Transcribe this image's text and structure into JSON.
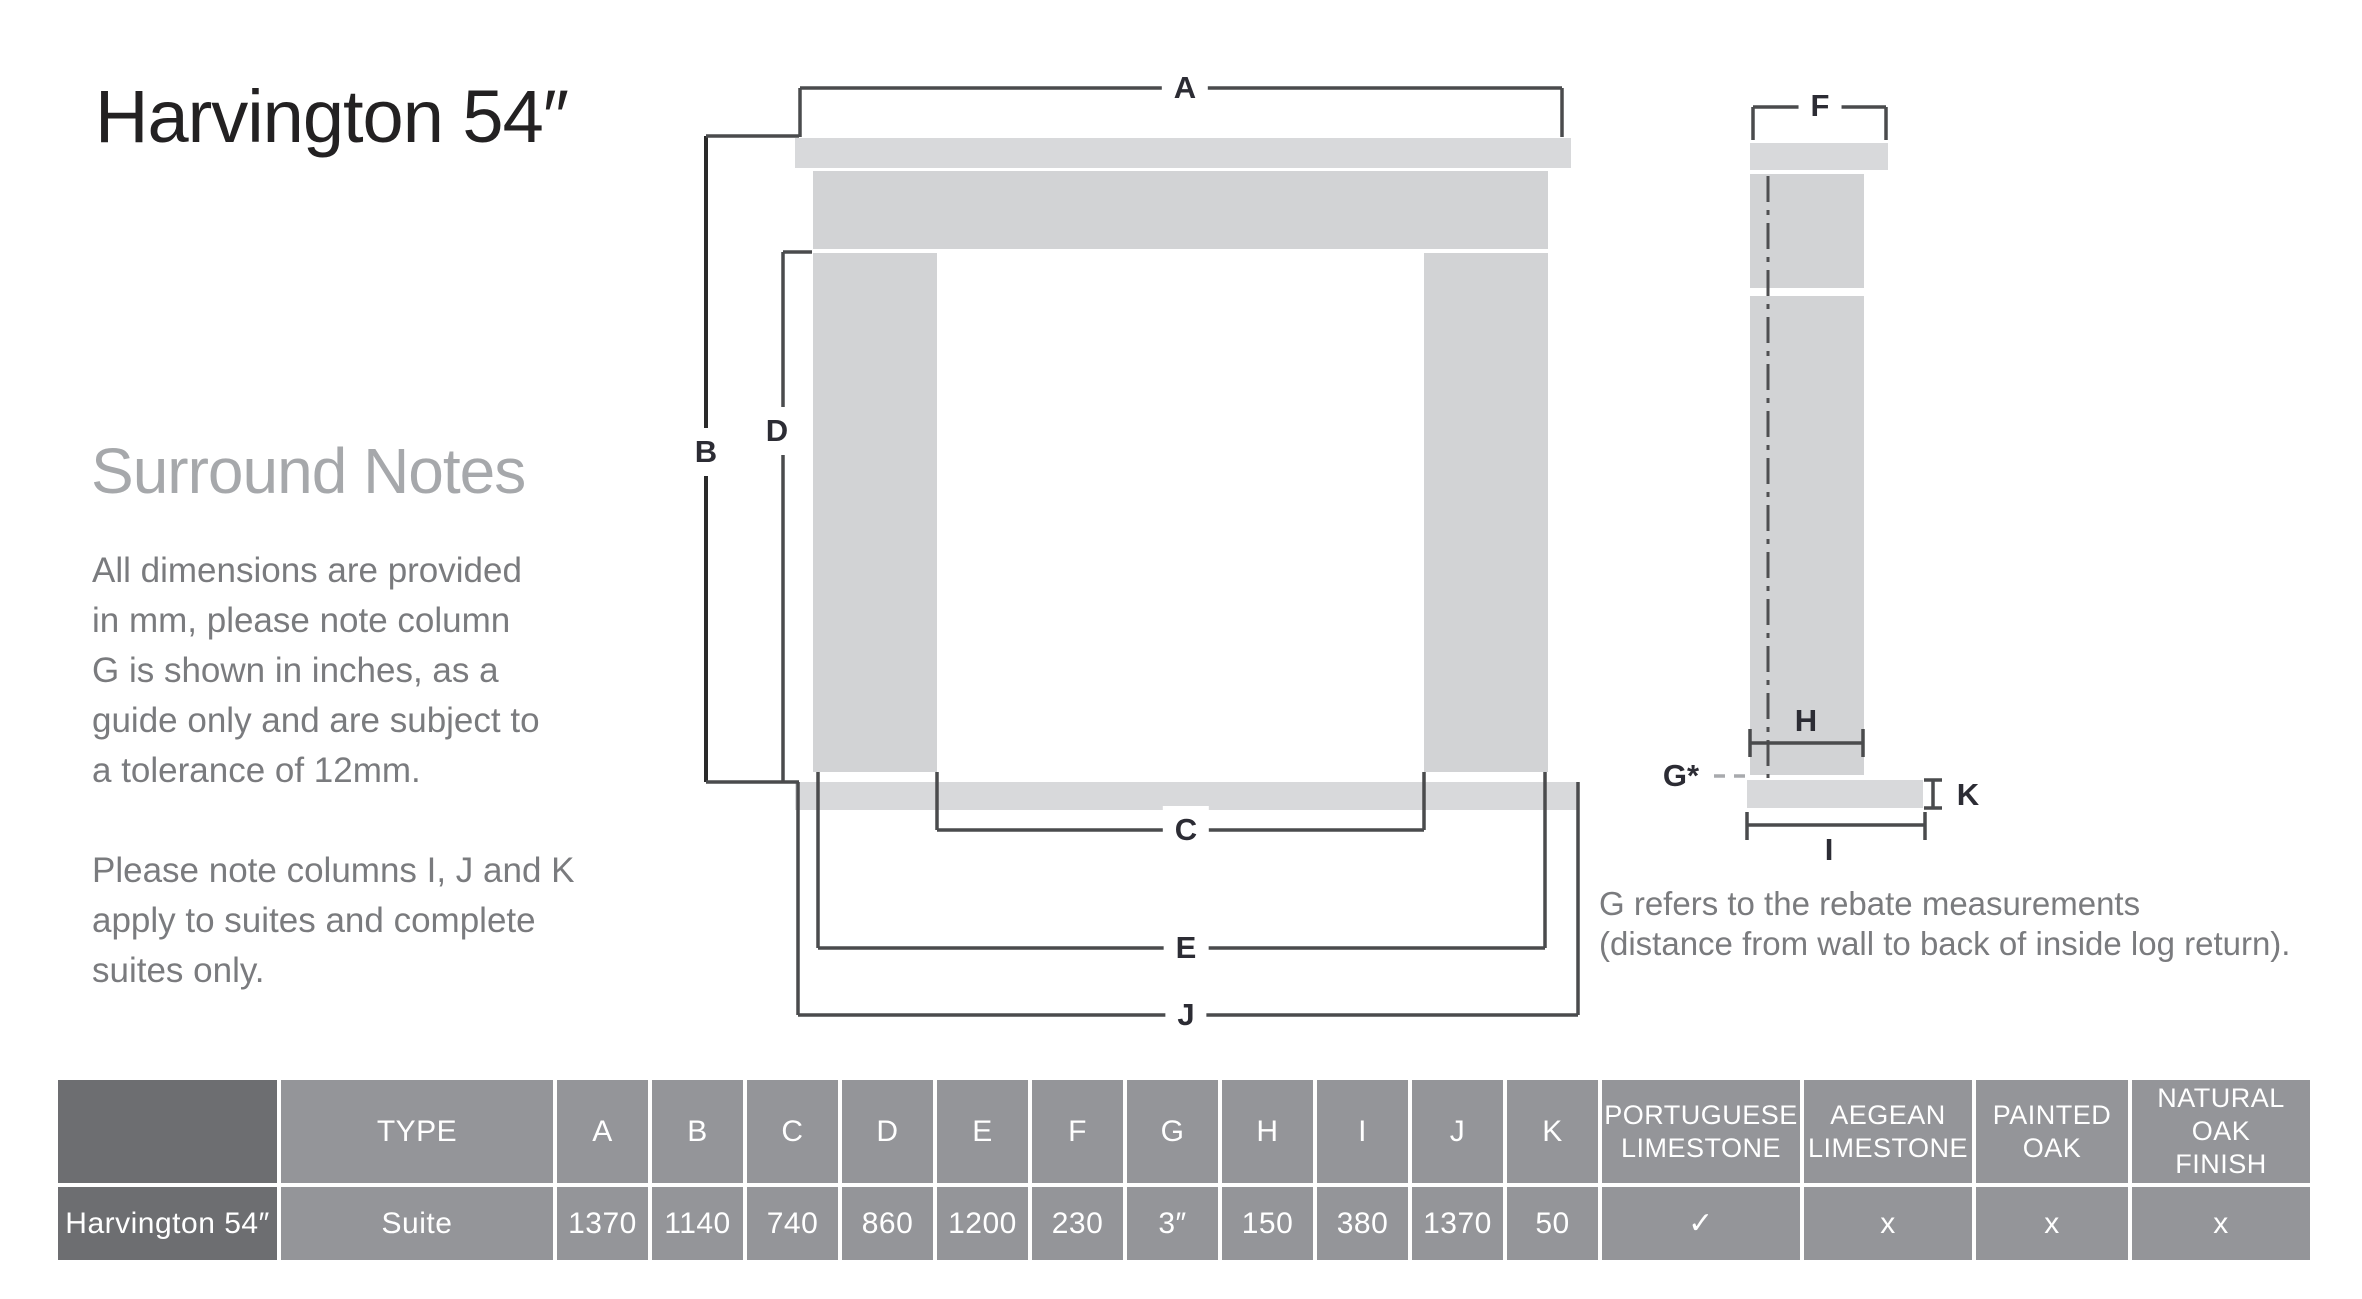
{
  "page": {
    "title": "Harvington 54″"
  },
  "notes": {
    "heading": "Surround Notes",
    "para1": "All dimensions are provided\nin mm, please note column\nG is shown in inches,  as a\nguide only and are subject to\na tolerance of 12mm.",
    "para2": "Please note columns I, J and K\napply to suites and complete\nsuites only."
  },
  "diagram": {
    "labels": {
      "a": "A",
      "b": "B",
      "c": "C",
      "d": "D",
      "e": "E",
      "f": "F",
      "g": "G*",
      "h": "H",
      "i": "I",
      "j": "J",
      "k": "K"
    },
    "caption": "G refers to the rebate measurements\n(distance from wall to back of inside log return)."
  },
  "table": {
    "type_header": "TYPE",
    "dim_headers": [
      "A",
      "B",
      "C",
      "D",
      "E",
      "F",
      "G",
      "H",
      "I",
      "J",
      "K"
    ],
    "finish_headers": [
      "PORTUGUESE\nLIMESTONE",
      "AEGEAN\nLIMESTONE",
      "PAINTED\nOAK",
      "NATURAL OAK\nFINISH"
    ],
    "row": {
      "name": "Harvington 54″",
      "type": "Suite",
      "dims": [
        "1370",
        "1140",
        "740",
        "860",
        "1200",
        "230",
        "3″",
        "150",
        "380",
        "1370",
        "50"
      ],
      "finishes": [
        "✓",
        "x",
        "x",
        "x"
      ]
    }
  },
  "colors": {
    "table_grey": "#949599",
    "table_dark": "#6d6e71",
    "diagram_fill": "#d2d3d5",
    "diagram_fill_light": "#d8d9db",
    "dim_line": "#4a4b4d",
    "text_grey": "#7a7b7e",
    "heading_grey": "#a6a8ab",
    "title_black": "#232122"
  }
}
